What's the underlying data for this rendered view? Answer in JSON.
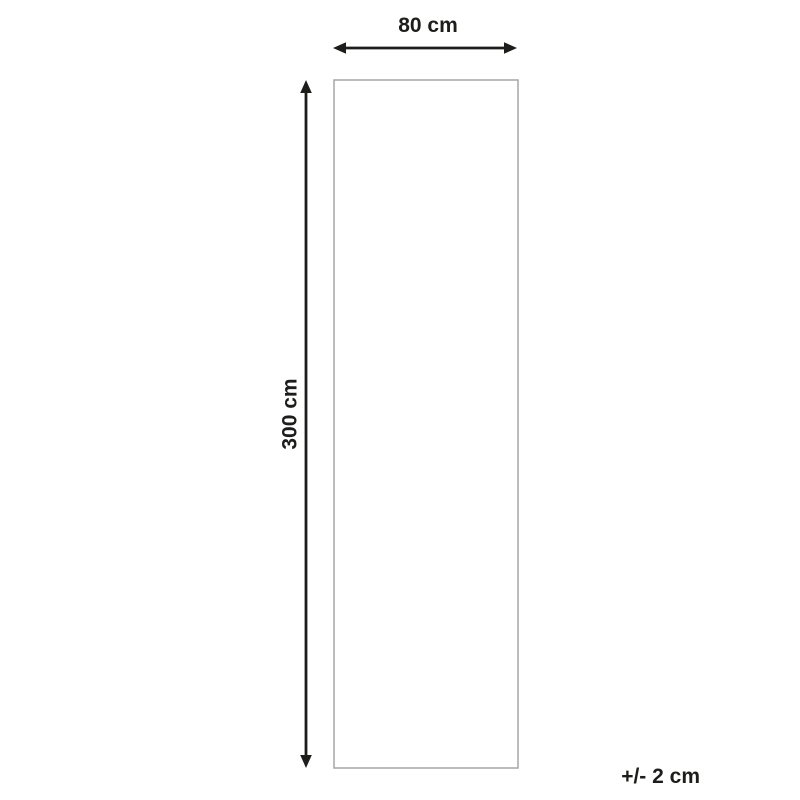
{
  "diagram": {
    "type": "product-dimension-diagram",
    "background_color": "#ffffff",
    "dimension_color": "#1d1d1b",
    "outline_color": "#a5a5a5",
    "width_dimension": {
      "label": "80 cm",
      "value": 80,
      "unit": "cm"
    },
    "height_dimension": {
      "label": "300 cm",
      "value": 300,
      "unit": "cm"
    },
    "tolerance": {
      "label": "+/- 2 cm",
      "value": 2,
      "unit": "cm"
    }
  }
}
